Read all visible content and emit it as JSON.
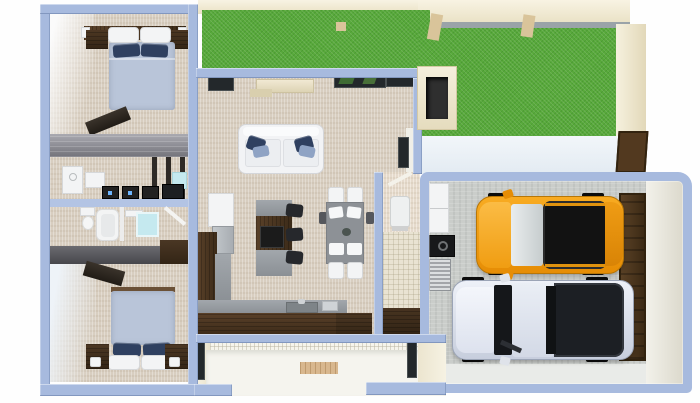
{
  "scene": {
    "type": "3d-floor-plan-top-view",
    "rooms": [
      {
        "name": "bedroom-top-left",
        "floor": "beige-carpet",
        "objects": [
          "double-bed",
          "white-pillows",
          "navy-pillows",
          "headboard-shelf",
          "nightstand-left",
          "nightstand-right",
          "wall-lamps",
          "open-door"
        ]
      },
      {
        "name": "laundry-closet",
        "floor": "beige-carpet",
        "objects": [
          "washer",
          "storage-box",
          "shelf-posts",
          "electronics-row"
        ]
      },
      {
        "name": "bathroom",
        "floor": "beige-carpet",
        "objects": [
          "toilet",
          "bathtub",
          "vanity",
          "shower-glass",
          "open-door"
        ]
      },
      {
        "name": "bedroom-bottom-left",
        "floor": "beige-carpet",
        "objects": [
          "double-bed",
          "white-pillows",
          "navy-pillows",
          "nightstand-left",
          "nightstand-right",
          "table-lamps",
          "wardrobe",
          "open-door"
        ]
      },
      {
        "name": "living-room",
        "floor": "beige-carpet",
        "objects": [
          "sofa-white",
          "accent-pillows",
          "media-console",
          "wall-tv",
          "window-left",
          "window-mid",
          "window-right",
          "side-doorway"
        ]
      },
      {
        "name": "kitchen-dining",
        "floor": "beige-carpet",
        "objects": [
          "tall-cabinet",
          "fridge",
          "l-counter",
          "sink",
          "toaster",
          "island",
          "cooktop",
          "bar-stool-1",
          "bar-stool-2",
          "bar-stool-3",
          "dining-table",
          "plates",
          "chair-top-1",
          "chair-top-2",
          "chair-bottom-1",
          "chair-bottom-2"
        ]
      },
      {
        "name": "pantry-hall",
        "floor": "tile",
        "objects": [
          "wall-sconce",
          "water-heater",
          "base-cabinet"
        ]
      },
      {
        "name": "garage",
        "floor": "concrete",
        "objects": [
          "wall-cabinet",
          "black-appliance",
          "silver-appliance",
          "orange-suv",
          "white-pickup",
          "garage-door",
          "driveway-apron"
        ]
      },
      {
        "name": "backyard-lawn",
        "floor": "grass",
        "objects": [
          "boundary-wall-top",
          "boundary-wall-right",
          "roof-beams",
          "chimney",
          "rear-gate",
          "patio-strip"
        ]
      },
      {
        "name": "entry-porch",
        "floor": "white-tile",
        "objects": [
          "mosaic-wall",
          "doormat",
          "window-left",
          "window-right"
        ]
      }
    ]
  },
  "palette": {
    "bg": "#fefefe",
    "wall-blue": "#a7bade",
    "carpet": "#d8cec0",
    "grass": "#58a93b",
    "concrete": "#cacdca",
    "concrete-light": "#e9ebe8",
    "navy": "#2f4060",
    "blanket": "#b9c5d9",
    "window-dark": "#23282b",
    "suv-orange": "#f59e10",
    "suv-roof": "#121212",
    "truck-silver": "#dde3ee",
    "truck-bed": "#1c1f24",
    "garage-door-brown": "#4a3522",
    "glass-blue": "#c5e9ef",
    "walnut": "#4e3826",
    "cream-wall": "#f1ead6",
    "porch-floor": "#f5f4ee",
    "patio": "#eef3f7"
  }
}
